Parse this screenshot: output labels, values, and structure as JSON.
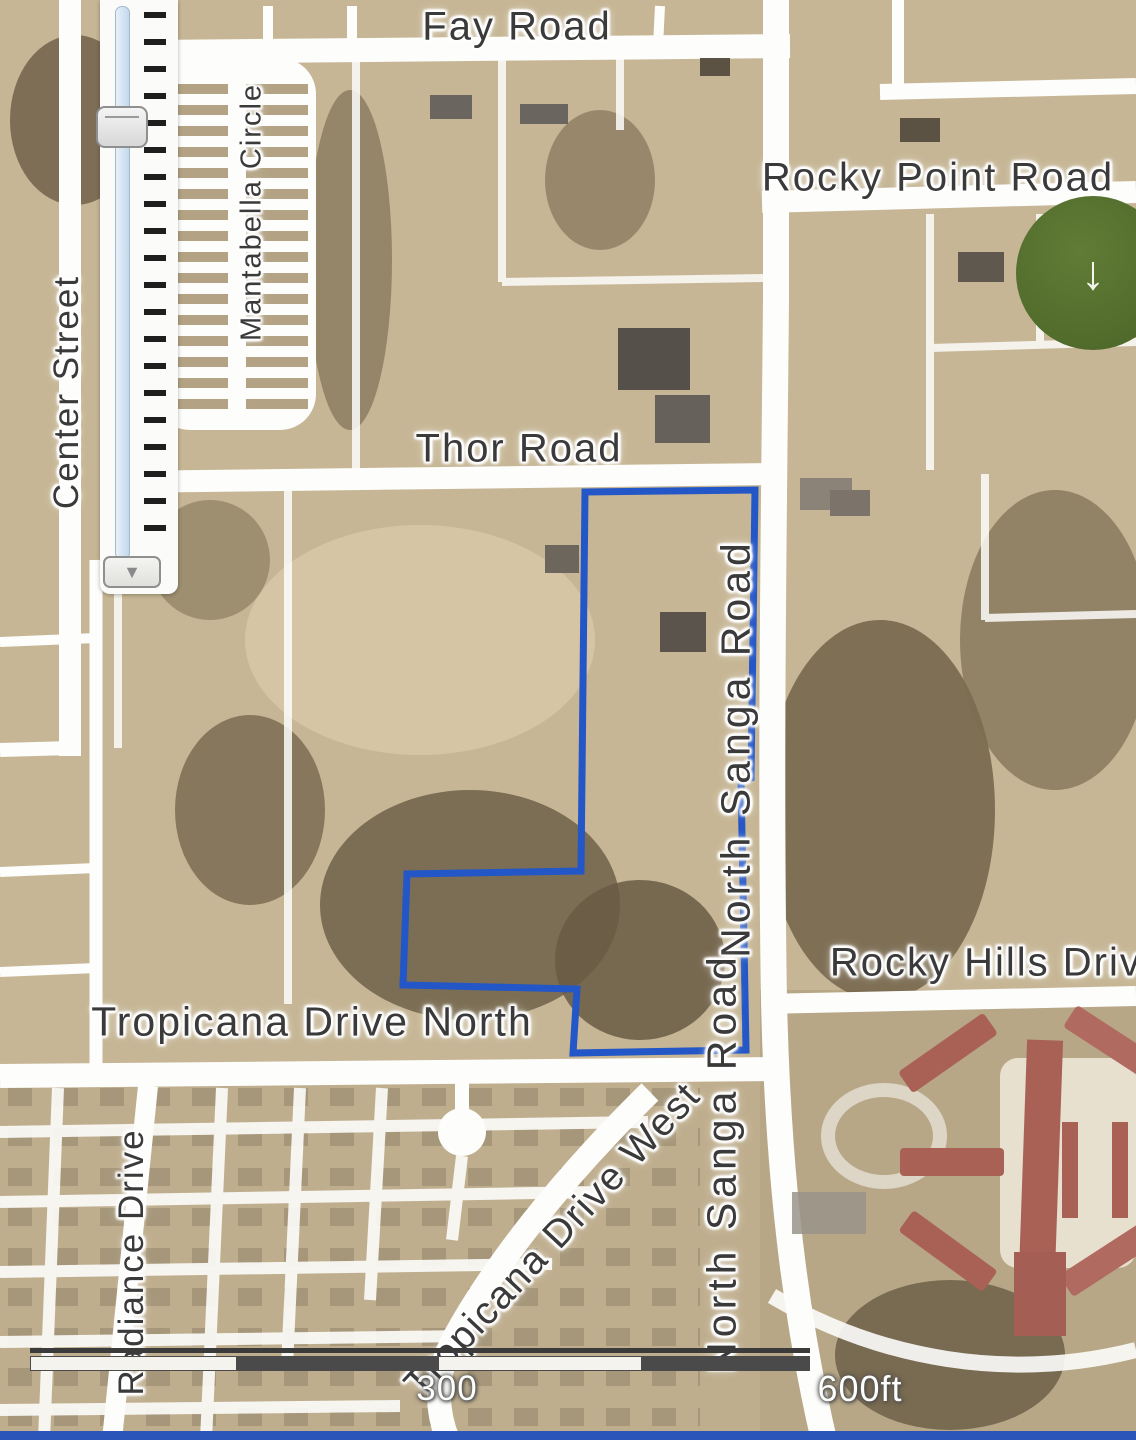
{
  "map": {
    "labels": {
      "fay_road": "Fay Road",
      "rocky_point_road": "Rocky Point Road",
      "mantabella_circle": "Mantabella Circle",
      "center_street": "Center Street",
      "thor_road": "Thor Road",
      "north_sanga_road_upper": "North Sanga Road",
      "north_sanga_road_lower": "North Sanga Road",
      "rocky_hills_drive": "Rocky Hills Drive",
      "tropicana_drive_north": "Tropicana Drive North",
      "radiance_drive": "Radiance Drive",
      "tropicana_drive_west": "Tropicana Drive West"
    },
    "parcel_outline": {
      "color": "#2356c7",
      "points": "585,492 755,490 751,778 741,781 746,1050 573,1053 577,989 403,985 407,874 581,871"
    },
    "colors": {
      "terrain": "#c6b695",
      "road": "#fdfdfb",
      "label_text": "#3a3a3a",
      "roof_red": "#a96156",
      "marker_green": "#57712f",
      "bottom_bar_blue": "#2b55b8"
    }
  },
  "controls": {
    "zoom_out_label": "▼",
    "marker_arrow": "↓"
  },
  "scale_bar": {
    "mid_label": "300",
    "end_label": "600ft"
  }
}
